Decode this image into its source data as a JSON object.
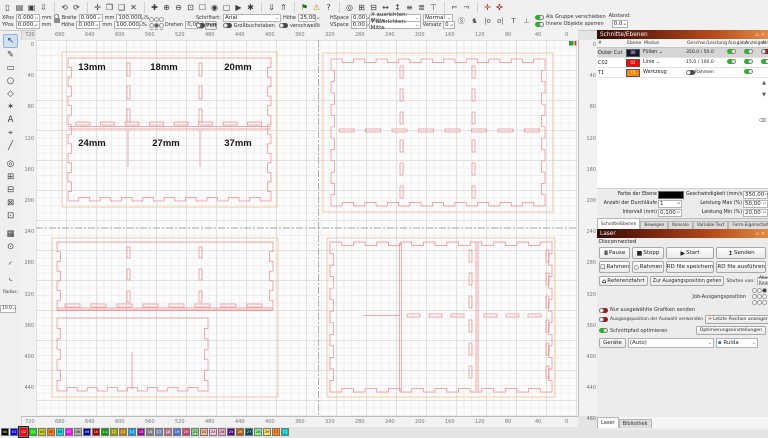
{
  "toolbar": {
    "row1": [
      {
        "name": "file-new-icon",
        "glyph": "▯"
      },
      {
        "name": "file-open-icon",
        "glyph": "▤"
      },
      {
        "name": "file-save-icon",
        "glyph": "▣"
      },
      {
        "name": "file-import-icon",
        "glyph": "⇩"
      },
      {
        "sep": true
      },
      {
        "name": "undo-icon",
        "glyph": "⟲"
      },
      {
        "name": "redo-icon",
        "glyph": "⟳"
      },
      {
        "sep": true
      },
      {
        "name": "move-icon",
        "glyph": "✛"
      },
      {
        "name": "copy-icon",
        "glyph": "❐"
      },
      {
        "name": "paste-icon",
        "glyph": "❑"
      },
      {
        "name": "delete-icon",
        "glyph": "✕"
      },
      {
        "sep": true
      },
      {
        "name": "zoom-plus-icon",
        "glyph": "✚"
      },
      {
        "name": "zoom-in-icon",
        "glyph": "⊕"
      },
      {
        "name": "zoom-out-icon",
        "glyph": "⊖"
      },
      {
        "name": "zoom-selection-icon",
        "glyph": "⊡"
      },
      {
        "name": "frame-selection-icon",
        "glyph": "☐"
      },
      {
        "name": "camera-icon",
        "glyph": "◉"
      },
      {
        "name": "screen-icon",
        "glyph": "▢"
      },
      {
        "name": "preview-icon",
        "glyph": "▶"
      },
      {
        "name": "settings-icon",
        "glyph": "✱"
      },
      {
        "sep": true
      },
      {
        "name": "send-to-laser-icon",
        "glyph": "⇓"
      },
      {
        "name": "user-origin-icon",
        "glyph": "⇑"
      },
      {
        "sep": true
      },
      {
        "name": "flag-icon",
        "glyph": "⚑",
        "color": "#1a6e1a"
      },
      {
        "name": "warning-icon",
        "glyph": "⚠",
        "color": "#b98700"
      },
      {
        "name": "help-icon",
        "glyph": "?"
      },
      {
        "sep": true
      },
      {
        "name": "show-origin-icon",
        "glyph": "◎"
      },
      {
        "name": "group-icon",
        "glyph": "⊞"
      },
      {
        "name": "ungroup-icon",
        "glyph": "⊟"
      },
      {
        "name": "mirror-horizontal-icon",
        "glyph": "↔"
      },
      {
        "name": "mirror-vertical-icon",
        "glyph": "↕"
      },
      {
        "name": "align-left-icon",
        "glyph": "≡"
      },
      {
        "name": "align-center-icon",
        "glyph": "≣"
      },
      {
        "name": "align-top-icon",
        "glyph": "⊤"
      },
      {
        "sep": true
      },
      {
        "name": "dock-left-icon",
        "glyph": "⌐"
      },
      {
        "name": "dock-right-icon",
        "glyph": "¬"
      },
      {
        "sep": true
      },
      {
        "name": "move-h-icon",
        "glyph": "✛",
        "color": "#b03030"
      },
      {
        "name": "move-v-icon",
        "glyph": "✜",
        "color": "#b03030"
      }
    ],
    "props": {
      "xpos_label": "XPos",
      "xpos": "0.000",
      "ypos_label": "YPos",
      "ypos": "0.000",
      "mm": "mm",
      "breite_label": "Breite",
      "breite": "0.000",
      "hoehe_label": "Höhe",
      "hoehe": "0.000",
      "scalex": "100.000",
      "scaley": "100.000",
      "pct": "%",
      "drehen_label": "Drehen",
      "drehen": "0,00",
      "mm_btn": "mm"
    },
    "font": {
      "schriftart": "Schriftart:",
      "family": "Arial",
      "hoehe_label": "Höhe",
      "hoehe": "25,00",
      "fett": "Fett",
      "kursiv": "Kursiv",
      "gross": "Großbuchstaben",
      "versetzen": "Versetzen",
      "weld": "verschweißt",
      "hspace_label": "HSpace",
      "hspace": "0,00",
      "vspace_label": "VSpace",
      "vspace": "0,00",
      "xalign": "X ausrichten: Mitte",
      "yalign": "Y ausrichten: Mitte",
      "normal": "Normal",
      "versatz_label": "Versatz",
      "versatz": "0"
    },
    "group": {
      "als_gruppe": "Als Gruppe verschieben",
      "innere": "Innere Objekte sperren",
      "abstand_label": "Abstand:",
      "abstand": "0.0",
      "icons": [
        {
          "name": "rotate-s-icon",
          "glyph": "Ⓢ"
        },
        {
          "name": "laser-head-icon",
          "glyph": "♞"
        },
        {
          "name": "distribute-h-icon",
          "glyph": "|o"
        },
        {
          "name": "distribute-v-icon",
          "glyph": "o|"
        },
        {
          "name": "align-text-icon",
          "glyph": "T"
        },
        {
          "name": "align-bottom-icon",
          "glyph": "⊥"
        }
      ]
    }
  },
  "left_tools": {
    "items": [
      {
        "name": "select-tool",
        "glyph": "↖",
        "active": true
      },
      {
        "name": "pen-tool",
        "glyph": "✎"
      },
      {
        "name": "rectangle-tool",
        "glyph": "▭"
      },
      {
        "name": "ellipse-tool",
        "glyph": "○"
      },
      {
        "name": "polygon-tool",
        "glyph": "◇"
      },
      {
        "name": "star-tool",
        "glyph": "✶"
      },
      {
        "name": "text-tool",
        "glyph": "A"
      },
      {
        "name": "position-tool",
        "glyph": "⌖"
      },
      {
        "name": "line-tool",
        "glyph": "╱"
      },
      {
        "name": "offset-tool",
        "glyph": "◎"
      },
      {
        "name": "boolean-union-tool",
        "glyph": "⊞"
      },
      {
        "name": "boolean-subtract-tool",
        "glyph": "⊟"
      },
      {
        "name": "boolean-intersect-tool",
        "glyph": "⊠"
      },
      {
        "name": "boolean-difference-tool",
        "glyph": "⊡"
      },
      {
        "name": "grid-array-tool",
        "glyph": "▦"
      },
      {
        "name": "circular-array-tool",
        "glyph": "⊙"
      },
      {
        "name": "corner-tool-a",
        "glyph": "◜"
      },
      {
        "name": "corner-tool-b",
        "glyph": "◟"
      }
    ],
    "radius_label": "Radius:",
    "radius": "10.0"
  },
  "canvas": {
    "ruler_top": [
      "720",
      "680",
      "640",
      "600",
      "560",
      "520",
      "480",
      "440",
      "400",
      "360",
      "320",
      "280",
      "240",
      "200",
      "160",
      "120",
      "80",
      "40",
      "0"
    ],
    "ruler_side": [
      "0",
      "40",
      "80",
      "120",
      "160",
      "200",
      "240",
      "280",
      "320",
      "360",
      "400",
      "440",
      "480"
    ],
    "labels": [
      "13mm",
      "18mm",
      "20mm",
      "24mm",
      "27mm",
      "37mm"
    ]
  },
  "cuts": {
    "title": "Schnitte/Ebenen",
    "columns": [
      "#",
      "Ebene",
      "Modus",
      "Geschw./Leistung",
      "Ausgabe",
      "Anzeigen",
      "Air"
    ],
    "rows": [
      {
        "name": "Outer Cut",
        "layer": "00",
        "color": "#14143c",
        "mode": "Füllen",
        "dropdown": true,
        "speed": "350.0 / 50.0",
        "ausgabe": "on",
        "anzeigen": "on",
        "air": "red",
        "selected": true
      },
      {
        "name": "C02",
        "layer": "02",
        "color": "#ff0000",
        "mode": "Linie",
        "dropdown": true,
        "speed": "15.0 / 100.0",
        "ausgabe": "on",
        "anzeigen": "on",
        "air": "on",
        "selected": false
      },
      {
        "name": "T1",
        "layer": "T1",
        "color": "#ff8800",
        "mode": "Werkzeug",
        "dropdown": false,
        "speed": "",
        "rahmen": "Rahmen",
        "ausgabe": "",
        "anzeigen": "on",
        "air": "",
        "selected": false
      }
    ],
    "props": {
      "farbe": "Farbe der Ebene",
      "geschw": "Geschwindigkeit (mm/s)",
      "geschw_v": "350,00",
      "anzahl": "Anzahl der Durchläufe",
      "anzahl_v": "1",
      "max": "Leistung Max (%)",
      "max_v": "50,00",
      "intervall": "Intervall (mm)",
      "intervall_v": "0,100",
      "min": "Leistung Min (%)",
      "min_v": "20,00"
    },
    "tabs": [
      "Schnitte/Ebenen",
      "Bewegen",
      "Konsole",
      "Variable Text",
      "Form-Eigenschaften"
    ]
  },
  "laser": {
    "title": "Laser",
    "status": "Disconnected",
    "pause": "Pause",
    "stopp": "Stopp",
    "start": "Start",
    "senden": "Senden",
    "rahmen1": "Rahmen",
    "rahmen2": "Rahmen",
    "rd_save": "RD file speichern",
    "rd_run": "RD file ausführen",
    "referenz": "Referenzfahrt",
    "zur_ausgang": "Zur Ausgangsposition gehen",
    "starten_label": "Starten von:",
    "starten": "Absolute Koordinaten",
    "job_origin": "Job-Ausgangsposition",
    "nur_ausgew": "Nur ausgewählte Grafiken senden",
    "ausgangspos": "Ausgangsposition der Auswahl verwenden",
    "letzte_pos": "Letzte Position anzeigen",
    "schnittpfad": "Schnittpfad optimieren",
    "optimierung": "Optimierungseinstellungen",
    "geraete": "Geräte",
    "auto": "(Auto)",
    "controller": "Ruida",
    "tabs": [
      "Laser",
      "Bibliothek"
    ]
  },
  "palette": {
    "selected": "02",
    "swatches": [
      {
        "id": "00",
        "color": "#000000"
      },
      {
        "id": "01",
        "color": "#0000ff"
      },
      {
        "id": "02",
        "color": "#ff0000"
      },
      {
        "id": "03",
        "color": "#00e000"
      },
      {
        "id": "04",
        "color": "#d0d000"
      },
      {
        "id": "05",
        "color": "#ff8000"
      },
      {
        "id": "06",
        "color": "#00e0e0"
      },
      {
        "id": "07",
        "color": "#ff00ff"
      },
      {
        "id": "08",
        "color": "#b4b4b4"
      },
      {
        "id": "09",
        "color": "#0000a0"
      },
      {
        "id": "10",
        "color": "#a00000"
      },
      {
        "id": "11",
        "color": "#00a000"
      },
      {
        "id": "12",
        "color": "#a0a000"
      },
      {
        "id": "13",
        "color": "#c08000"
      },
      {
        "id": "14",
        "color": "#00a0ff"
      },
      {
        "id": "15",
        "color": "#a000a0"
      },
      {
        "id": "16",
        "color": "#808080"
      },
      {
        "id": "17",
        "color": "#7d87b9"
      },
      {
        "id": "18",
        "color": "#bb7784"
      },
      {
        "id": "19",
        "color": "#4a6fe3"
      },
      {
        "id": "20",
        "color": "#d33f6a"
      },
      {
        "id": "21",
        "color": "#8cd78c"
      },
      {
        "id": "22",
        "color": "#f0b98d"
      },
      {
        "id": "23",
        "color": "#f6c4e1"
      },
      {
        "id": "24",
        "color": "#fa9ed4"
      },
      {
        "id": "25",
        "color": "#500a78"
      },
      {
        "id": "26",
        "color": "#b45a00"
      },
      {
        "id": "27",
        "color": "#004754"
      },
      {
        "id": "28",
        "color": "#86fa88"
      },
      {
        "id": "29",
        "color": "#ffdb66"
      },
      {
        "id": "T1",
        "color": "#ff8800"
      },
      {
        "id": "T2",
        "color": "#00c0c0"
      }
    ]
  }
}
